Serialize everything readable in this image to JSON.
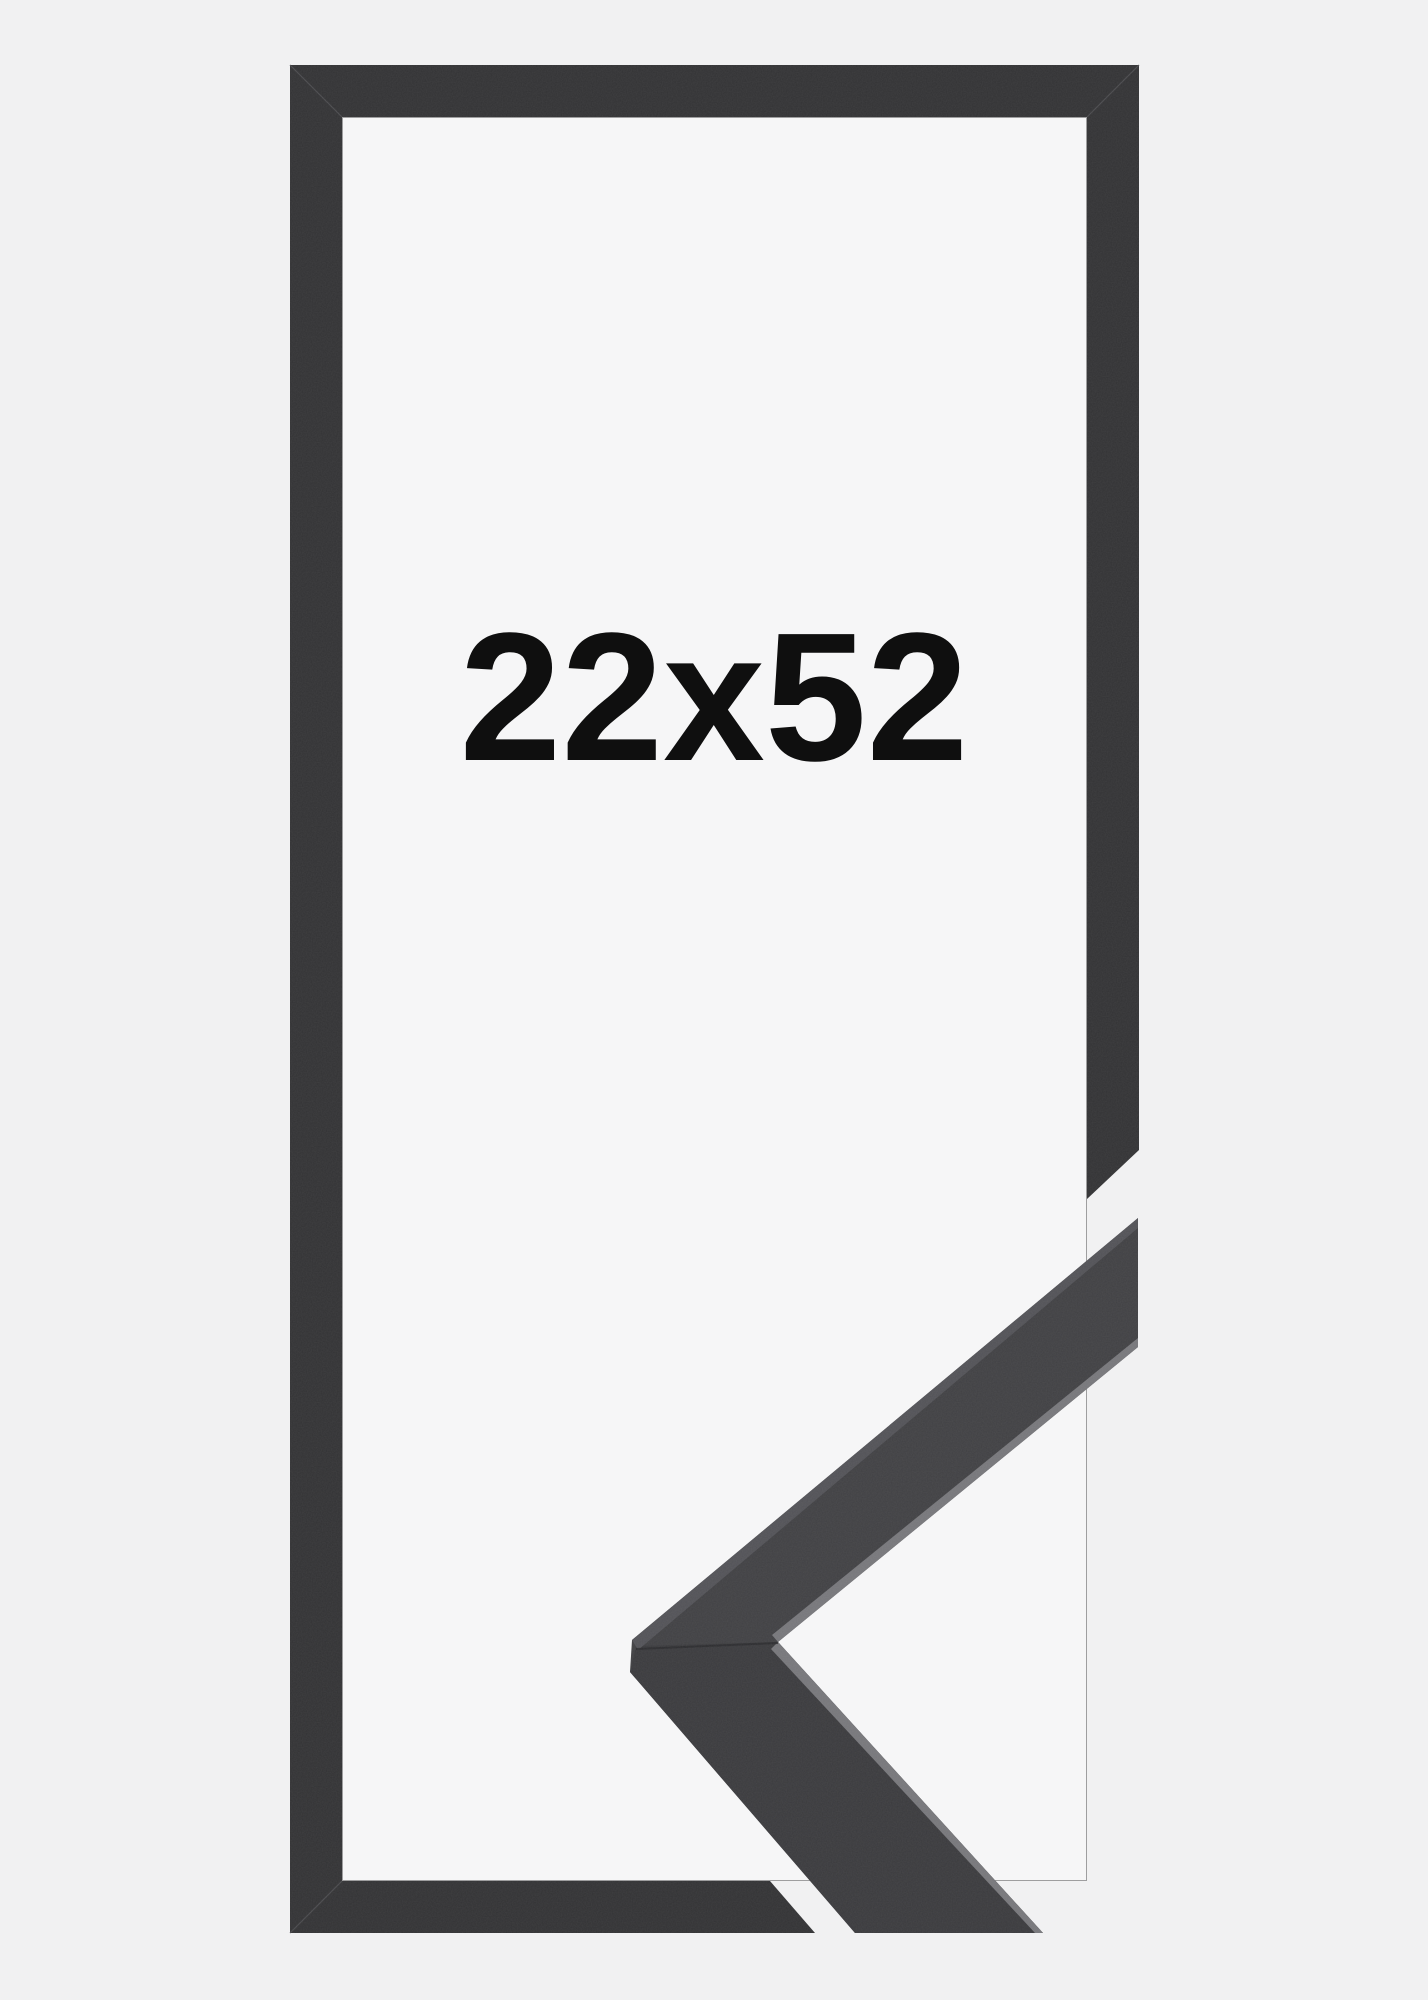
{
  "image": {
    "size_label": "22x52"
  },
  "colors": {
    "background": "#f1f1f2",
    "frame_interior": "#f6f6f7",
    "frame": "#323234",
    "frame_seam": "#4a4a4d",
    "inner_edge": "#454548",
    "sample_front_upper": "#404043",
    "sample_front_lower": "#3a3a3d",
    "sample_top_face": "#525257",
    "sample_edge_highlight": "#77777b",
    "sample_seam": "#29292c",
    "label_text": "#0f0f0f"
  }
}
